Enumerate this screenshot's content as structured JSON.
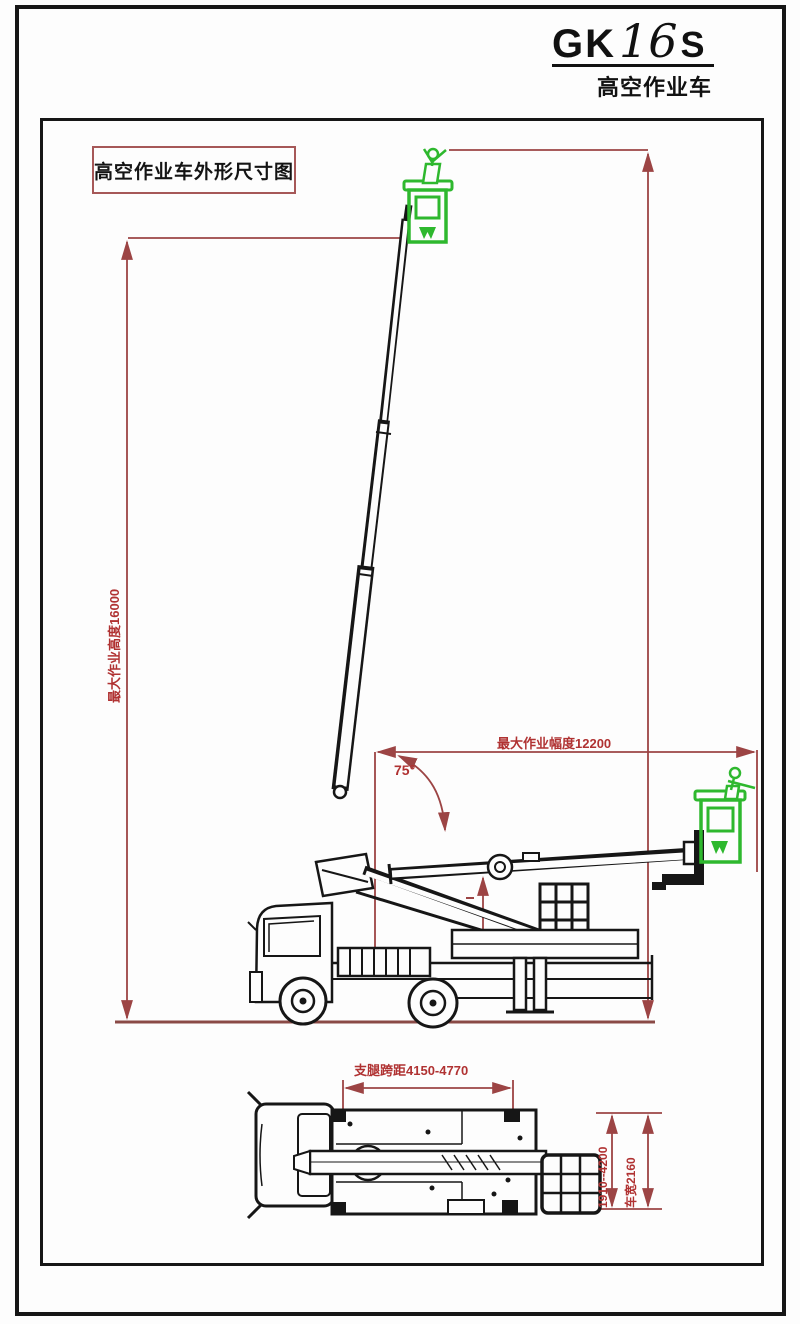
{
  "title_block": {
    "model_prefix": "GK",
    "model_number": "16",
    "model_suffix": "S",
    "subtitle": "高空作业车"
  },
  "drawing": {
    "caption": "高空作业车外形尺寸图"
  },
  "dimensions": {
    "max_working_height": "最大作业高度16000",
    "max_working_radius": "最大作业幅度12200",
    "boom_angle": "75°",
    "outrigger_longitudinal_span": "支腿跨距4150-4770",
    "outrigger_lateral_span": "1910--4200",
    "vehicle_width": "车宽2160"
  },
  "colors": {
    "dimension_line": "#9c4444",
    "dimension_text": "#b03232",
    "ground_line": "#8a4a46",
    "basket_green": "#2eb82e",
    "drawing_black": "#161616",
    "caption_border": "#a65858"
  }
}
